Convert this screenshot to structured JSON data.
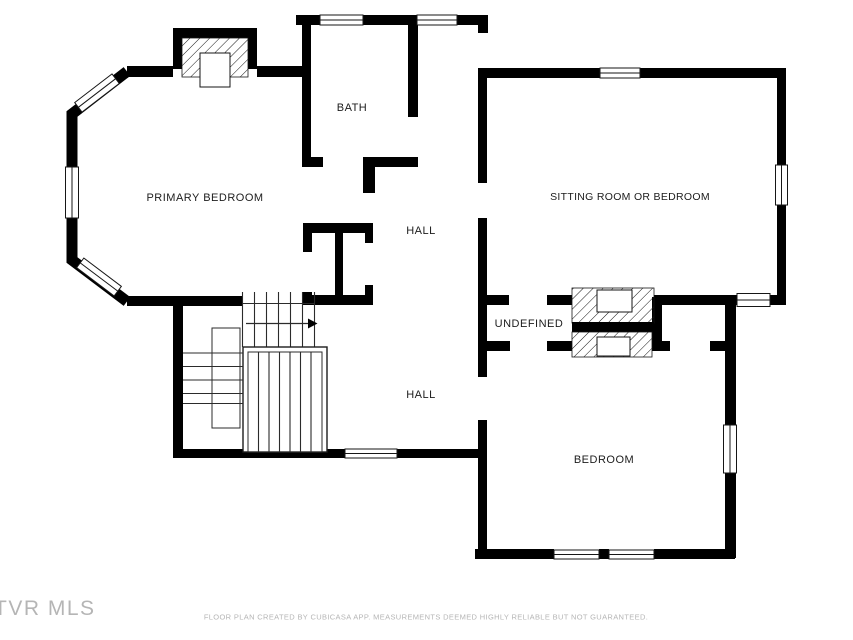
{
  "floorplan": {
    "rooms": {
      "primary_bedroom": "PRIMARY BEDROOM",
      "bath": "BATH",
      "sitting_room": "SITTING ROOM OR BEDROOM",
      "hall_upper": "HALL",
      "undefined_area": "UNDEFINED",
      "hall_lower": "HALL",
      "bedroom": "BEDROOM"
    },
    "watermark": "TVR MLS",
    "disclaimer": "FLOOR PLAN CREATED BY CUBICASA APP. MEASUREMENTS DEEMED HIGHLY RELIABLE BUT NOT GUARANTEED.",
    "colors": {
      "wall": "#000000",
      "background": "#ffffff",
      "label": "#1c1c1c",
      "disclaimer": "#b5b5b5",
      "watermark": "#a9a9a9"
    }
  }
}
